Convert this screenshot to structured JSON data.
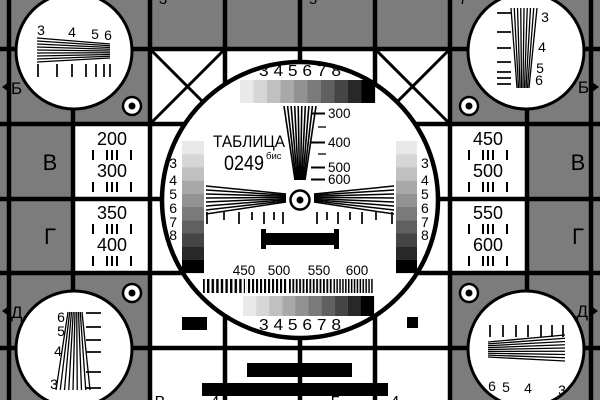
{
  "card": {
    "title": {
      "line1": "ТАБЛИЦА",
      "number": "0249",
      "suffix": "бис"
    }
  },
  "colors": {
    "background_gray": "#7c7c7c",
    "white": "#ffffff",
    "black": "#000000",
    "gray_steps": [
      "#e9e9e9",
      "#d6d6d6",
      "#c0c0c0",
      "#a9a9a9",
      "#929292",
      "#7a7a7a",
      "#606060",
      "#454545",
      "#282828",
      "#000000"
    ]
  },
  "center": {
    "top_scale": "3 4 5 6 7 8",
    "bottom_scale": "3 4 5 6 7 8",
    "left_scale": [
      "3",
      "4",
      "5",
      "6",
      "7",
      "8"
    ],
    "right_scale": [
      "3",
      "4",
      "5",
      "6",
      "7",
      "8"
    ],
    "wedge_marks": [
      "300",
      "400",
      "500",
      "600"
    ],
    "frequency_labels": [
      "450",
      "500",
      "550",
      "600"
    ]
  },
  "corners": {
    "top_left": [
      "3",
      "4",
      "5",
      "6"
    ],
    "top_right": [
      "3",
      "4",
      "5",
      "6"
    ],
    "bottom_left": [
      "6",
      "5",
      "4",
      "3"
    ],
    "bottom_right": [
      "6",
      "5",
      "4",
      "3"
    ]
  },
  "side_cells": {
    "left_upper": [
      "200",
      "300"
    ],
    "left_lower": [
      "350",
      "400"
    ],
    "right_upper": [
      "450",
      "500"
    ],
    "right_lower": [
      "550",
      "600"
    ]
  },
  "row_labels": {
    "left_b": "Б",
    "right_b": "Б",
    "left_v": "В",
    "right_v": "В",
    "left_g": "Г",
    "right_g": "Г",
    "left_d": "Д",
    "right_d": "Д"
  },
  "edge_fragments": {
    "top": [
      "3",
      "5",
      "7"
    ],
    "bottom": [
      "В",
      "4",
      "Г",
      "4"
    ]
  }
}
